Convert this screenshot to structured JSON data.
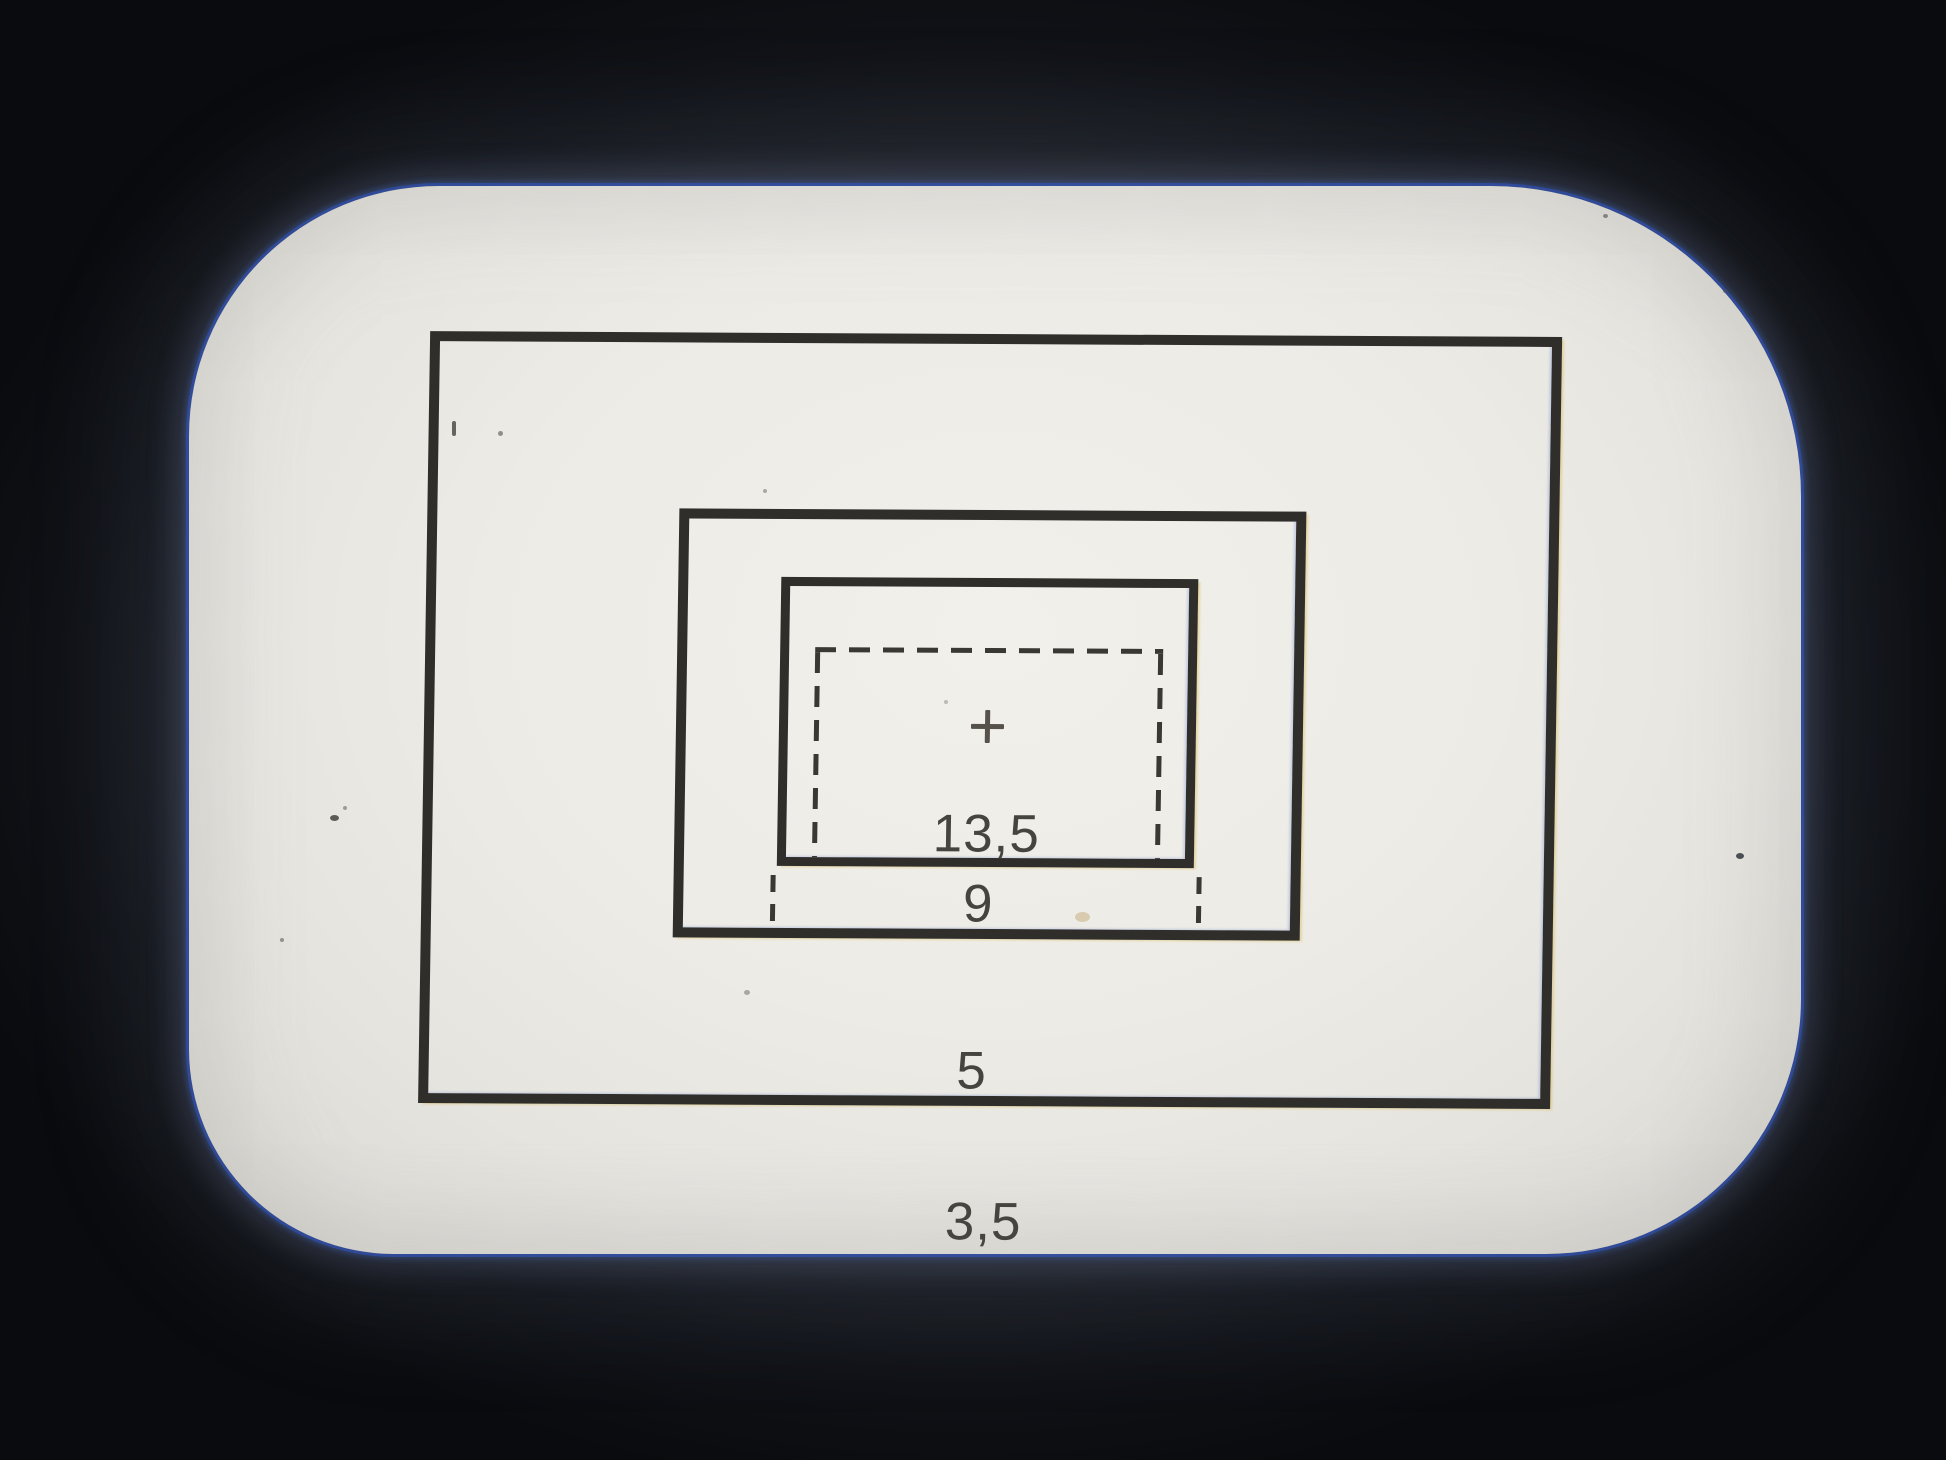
{
  "viewfinder": {
    "type_note": "camera viewfinder ground glass with focal-length frame lines",
    "frames": {
      "f135": {
        "label": "13,5"
      },
      "f9": {
        "label": "9"
      },
      "f5": {
        "label": "5"
      },
      "f35": {
        "label": "3,5"
      }
    },
    "center_marker": "+",
    "colors": {
      "background": "#0b0c0e",
      "glass": "#efede7",
      "frame_line": "#2f2e2b",
      "dashed_line": "#3a3833",
      "label_text": "#46443e",
      "edge_fringe_blue": "#2f5cd0",
      "edge_fringe_yellow": "#d9b32e"
    }
  }
}
